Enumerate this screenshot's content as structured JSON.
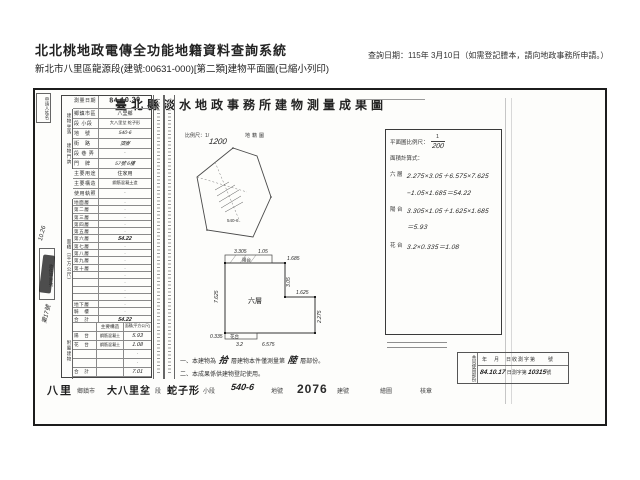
{
  "header": {
    "system_title": "北北桃地政電傳全功能地籍資料查詢系統",
    "query_date": "查詢日期：115年 3月10日（如需登記謄本，請向地政事務所申請。）",
    "subtitle": "新北市八里區龍源段(建號:00631-000)[第二類]建物平面圖(已縮小列印)"
  },
  "doc": {
    "title": "臺北縣淡水地政事務所建物測量成果圖",
    "applicant_label": "申請人姓名",
    "table": {
      "info": [
        {
          "label": "測量日期",
          "value": "84.10.30"
        },
        {
          "label": "鄉鎮市區",
          "value": "八里鄉"
        },
        {
          "label": "段 小段",
          "value": "大八里坌 蛇子形"
        },
        {
          "label": "地　號",
          "value": "540-6"
        },
        {
          "label": "街　路",
          "value": "頂寮"
        },
        {
          "label": "段 巷 弄",
          "value": "·"
        },
        {
          "label": "門　牌",
          "value": "57號 6樓"
        },
        {
          "label": "主要用途",
          "value": "住家用"
        },
        {
          "label": "主要構造",
          "value": "鋼筋混凝土造"
        },
        {
          "label": "使用執照",
          "value": "·"
        }
      ],
      "side_labels": {
        "location": "建物坐落",
        "address": "建物門牌",
        "area": "面積（平方公尺）",
        "annex": "附屬建物"
      },
      "floors": [
        {
          "label": "地面層",
          "value": "·"
        },
        {
          "label": "第二層",
          "value": "·"
        },
        {
          "label": "第三層",
          "value": "·"
        },
        {
          "label": "第四層",
          "value": "·"
        },
        {
          "label": "第五層",
          "value": "·"
        },
        {
          "label": "第六層",
          "value": "54.22"
        },
        {
          "label": "第七層",
          "value": "·"
        },
        {
          "label": "第八層",
          "value": "·"
        },
        {
          "label": "第九層",
          "value": "·"
        },
        {
          "label": "第十層",
          "value": "·"
        },
        {
          "label": "",
          "value": "·"
        },
        {
          "label": "",
          "value": "·"
        },
        {
          "label": "",
          "value": "·"
        },
        {
          "label": "",
          "value": "·"
        },
        {
          "label": "地下層",
          "value": "·"
        },
        {
          "label": "騎　樓",
          "value": "·"
        },
        {
          "label": "合　計",
          "value": "54.22"
        }
      ],
      "annex": {
        "header": {
          "structure": "主要構造",
          "area": "面積(平方公尺)"
        },
        "rows": [
          {
            "label": "陽　台",
            "structure": "鋼筋混凝土",
            "value": "5.93"
          },
          {
            "label": "花　台",
            "structure": "鋼筋混凝土",
            "value": "1.08"
          },
          {
            "label": "",
            "structure": "",
            "value": "·"
          },
          {
            "label": "",
            "structure": "",
            "value": "·"
          },
          {
            "label": "合　計",
            "structure": "",
            "value": "7.01"
          }
        ]
      }
    },
    "stamp": {
      "box_label": "收件字第號",
      "hand_date": "10.26",
      "hand_no": "第17號"
    },
    "sketch": {
      "scale_label": "比例尺：1/",
      "scale_value": "1200",
      "map_label": "地籍圖",
      "lot": "540-6"
    },
    "plan": {
      "label_center": "六層",
      "label_balcony": "陽台",
      "label_flower": "花台",
      "dims": {
        "top_left": "3.305",
        "top_mid": "1.05",
        "top_right": "1.685",
        "left": "7.625",
        "right_upper": "3.05",
        "right_lower": "2.275",
        "step": "1.625",
        "bottom": "6.575",
        "bottom_left": "0.335",
        "flower_len": "3.2"
      }
    },
    "calc": {
      "scale_label": "平面圖比例尺：",
      "scale_num": "1",
      "scale_den": "200",
      "formula_label": "面積計算式：",
      "lines": [
        {
          "label": "六 層",
          "expr": "2.275×3.05＋6.575×7.625"
        },
        {
          "label": "",
          "expr": "−1.05×1.685＝54.22"
        },
        {
          "label": "陽 台",
          "expr": "3.305×1.05＋1.625×1.685"
        },
        {
          "label": "",
          "expr": "＝5.93"
        },
        {
          "label": "花 台",
          "expr": "3.2×0.335＝1.08"
        }
      ]
    },
    "notes": {
      "line1_a": "一、本建物為",
      "line1_hand1": "拾",
      "line1_b": "層建物本件僅測量第",
      "line1_hand2": "陸",
      "line1_c": "層部份。",
      "line2": "二、本成果係供建物登記使用。"
    },
    "receipt": {
      "side_label": "共同使用部份",
      "line1": "年　月　日收測字第　　號",
      "date": "84.10.17",
      "mid": "日測字第",
      "no": "10315",
      "end": "號"
    },
    "strip": {
      "town": "八里",
      "town_label": "鄉鎮市",
      "sec": "大八里坌",
      "sec_label": "段",
      "subsec": "蛇子形",
      "subsec_label": "小段",
      "lot": "540-6",
      "lot_label": "地號",
      "bno": "2076",
      "bno_label": "建號",
      "draw": "繪圖",
      "seal": "核章"
    }
  }
}
